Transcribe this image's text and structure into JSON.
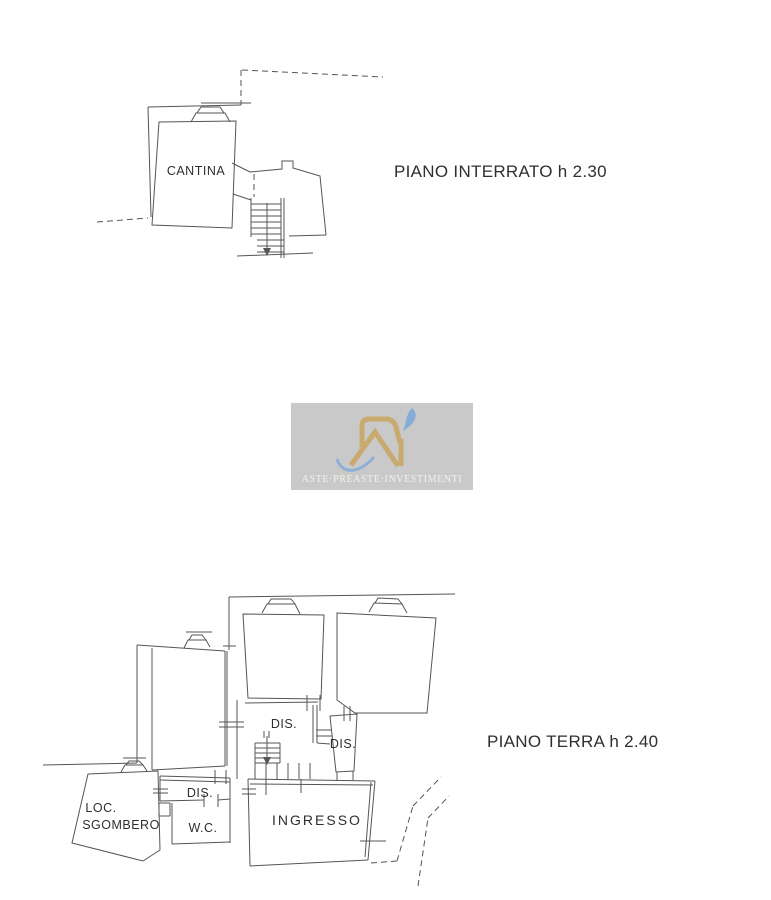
{
  "page": {
    "background": "#ffffff",
    "line_color": "#555555",
    "text_color": "#2f2f2f"
  },
  "floors": [
    {
      "id": "piano-interrato",
      "title": "PIANO INTERRATO h 2.30",
      "rooms": [
        {
          "label": "CANTINA"
        }
      ],
      "features": [
        "staircase",
        "window-symbol",
        "dashed-boundary"
      ]
    },
    {
      "id": "piano-terra",
      "title": "PIANO TERRA h 2.40",
      "rooms": [
        {
          "label": "DIS."
        },
        {
          "label": "DIS."
        },
        {
          "label": "DIS."
        },
        {
          "label": "W.C."
        },
        {
          "label": "INGRESSO"
        },
        {
          "label": "LOC. SGOMBERO",
          "line1": "LOC.",
          "line2": "SGOMBERO"
        }
      ],
      "features": [
        "staircase",
        "window-symbols",
        "dashed-boundary"
      ]
    }
  ],
  "watermark": {
    "monogram": "RI",
    "caption": "ASTE·PREASTE·INVESTIMENTI",
    "panel_color": "#c9c9c9",
    "gold": "#c9aa6e",
    "blue": "#85abd7",
    "caption_color": "#f3f1ea"
  }
}
